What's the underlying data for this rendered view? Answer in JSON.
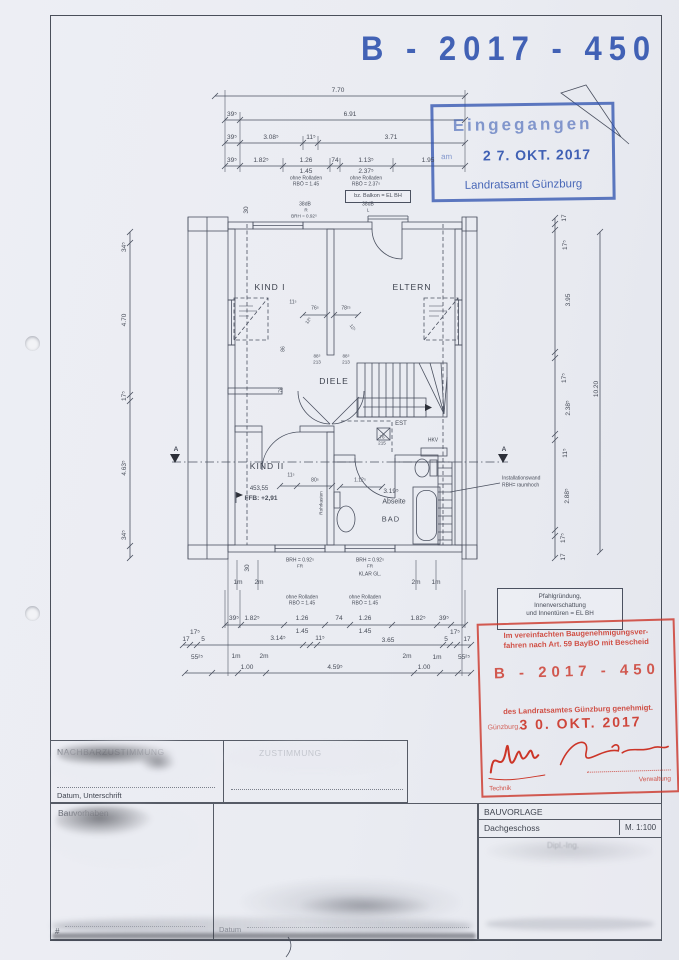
{
  "page": {
    "number_stamp": "B - 2017 - 450"
  },
  "received_stamp": {
    "title": "Eingegangen",
    "am": "am",
    "date": "2 7. OKT. 2017",
    "office": "Landratsamt Günzburg"
  },
  "approval_stamp": {
    "line1": "Im vereinfachten Baugenehmigungsver-",
    "line2": "fahren nach Art. 59 BayBO mit Bescheid",
    "number": "B - 2017 - 450",
    "line3": "des Landratsamtes Günzburg genehmigt.",
    "city": "Günzburg,",
    "date": "3 0. OKT. 2017",
    "label_left": "Technik",
    "label_right": "Verwaltung"
  },
  "plan": {
    "rooms": {
      "kind1": "KIND I",
      "eltern": "ELTERN",
      "diele": "DIELE",
      "kind2": "KIND II",
      "abseite": "Abseite",
      "bad": "BAD",
      "est": "EST",
      "hkv": "HKV"
    },
    "labels": {
      "level": "453,55",
      "ffb": "FFB: +2,91",
      "rohrkasten": "Rohrkasten",
      "install1": "Installationswand",
      "install2": "RBH= raumhoch",
      "balkon": "bz. Balkon = EL BH",
      "db_left": "38dB",
      "db_left_sub": "R",
      "db_right": "38dB",
      "db_right_sub": "L",
      "brh_top": "BRH = 0.92⁵",
      "brh_b1": "BRH = 0.92⁵",
      "fr1": "FR",
      "brh_b2": "BRH = 0.92⁵",
      "fr2": "FR",
      "klar": "KLAR GL.",
      "v30_top": "30",
      "v30_bottom": "30",
      "section_a_left": "A",
      "section_a_right": "A"
    },
    "note_box": {
      "l1": "Pfahlgründung,",
      "l2": "Innenverschattung",
      "l3": "und Innentüren = EL BH"
    },
    "rolladen": {
      "t1a": "ohne Rolladen",
      "t1b": "RBÖ = 1.45",
      "t2a": "ohne Rolladen",
      "t2b": "RBÖ = 2.37⁵",
      "b1a": "ohne Rolladen",
      "b1b": "RBÖ = 1.45",
      "b2a": "ohne Rolladen",
      "b2b": "RBÖ = 1.45"
    },
    "dims": {
      "top_total": "7.70",
      "top_r2": [
        "39⁵",
        "6.91"
      ],
      "top_r3": [
        "39⁵",
        "3.08⁵",
        "11⁵",
        "3.71"
      ],
      "top_r4": [
        "39⁵",
        "1.82⁵",
        "1.26",
        "74",
        "1.13⁵",
        "1.95"
      ],
      "top_r4_sub": [
        "1.45",
        "2.37⁵"
      ],
      "left": [
        "34⁵",
        "4.70",
        "17⁵",
        "4.63⁵",
        "34⁵"
      ],
      "right": [
        "17",
        "17⁵",
        "3.95",
        "17⁵",
        "2.38⁵",
        "11⁵",
        "2.88⁵",
        "17⁵",
        "17"
      ],
      "right_total": "10.20",
      "bottom_r1": [
        "39⁵",
        "1.82⁵",
        "1.26",
        "74",
        "1.26",
        "1.82⁵",
        "39⁵"
      ],
      "bottom_r1_sub": [
        "1.45",
        "1.45"
      ],
      "bottom_r2": [
        "17",
        "17⁵",
        "5",
        "3.14⁵",
        "11⁵",
        "3.65",
        "5",
        "17⁵",
        "17"
      ],
      "bottom_r3": [
        "55²⁵",
        "1m",
        "1.00",
        "2m",
        "4.59⁵",
        "2m",
        "1.00",
        "1m",
        "55²⁵"
      ],
      "meters": [
        "1m",
        "2m",
        "2m",
        "1m"
      ],
      "inner": {
        "d11": "11⁵",
        "d76": "76⁵",
        "d78": "78²⁵",
        "v86": "86",
        "v76": "76",
        "door1a": "88⁵",
        "door1b": "213",
        "door2a": "88⁵",
        "door2b": "213",
        "d12l": "12⁵",
        "d12r": "12⁵",
        "k11": "11⁵",
        "k80": "80⁵",
        "b112": "1.12⁵",
        "b319": "3.19⁵",
        "est_a": "76",
        "est_b": "215"
      }
    }
  },
  "titleblock": {
    "header": "BAUVORLAGE",
    "sheet": "Dachgeschoss",
    "scale": "M. 1:100",
    "faint": "Dipl.-Ing."
  },
  "forms": {
    "cell1_title": "NACHBARZUSTIMMUNG",
    "cell2_title": "ZUSTIMMUNG",
    "datum_unterschrift": "Datum, Unterschrift",
    "bauvorhaben": "Bauvorhaben",
    "hash": "#",
    "datum": "Datum"
  },
  "colors": {
    "stamp_blue": "#2e52ad",
    "stamp_red": "#cc3528",
    "paper": "#eaecf2",
    "ink": "#474c58"
  }
}
